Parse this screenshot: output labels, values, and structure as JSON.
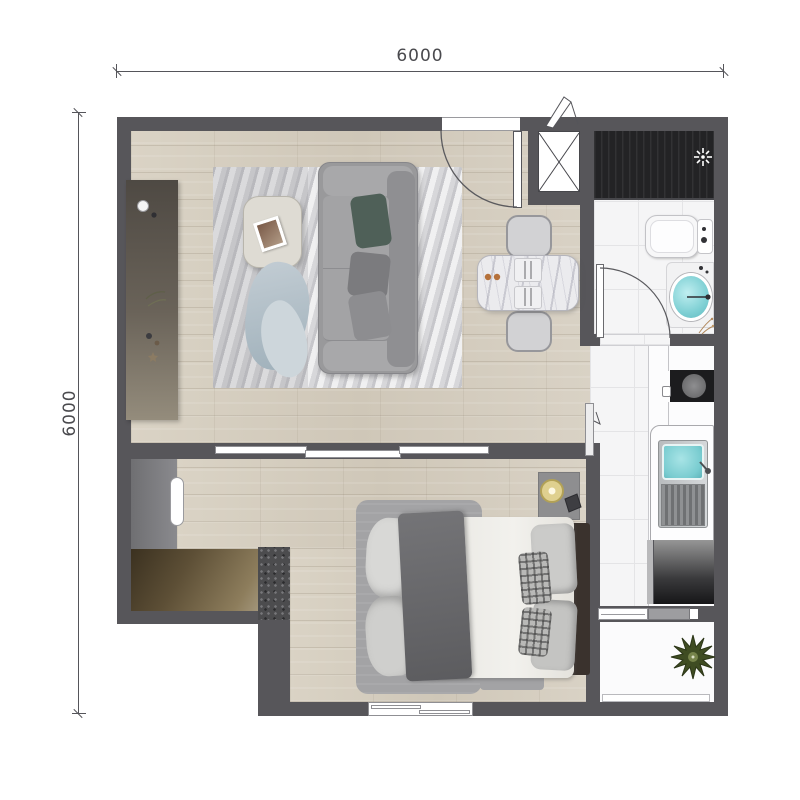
{
  "plan": {
    "dimension_top_label": "6000",
    "dimension_left_label": "6000"
  },
  "icons": {
    "exhaust_fan": "small white 4-blade fan glyph",
    "duct_shaft": "box with X cross",
    "door_swing": "quarter-circle arc",
    "plant": "green 12-point starburst"
  },
  "colors": {
    "wall": "#57565a",
    "wood_floor": "#d8d1c3",
    "tile_floor": "#f5f5f6",
    "utility_dark": "#232325",
    "counter_white": "#fcfcfc",
    "basin_teal": "#7fd0d4",
    "wardrobe_brown": "#6a5a3e",
    "plant_green": "#3f4c22",
    "dimension_text": "#4a4a4e"
  }
}
